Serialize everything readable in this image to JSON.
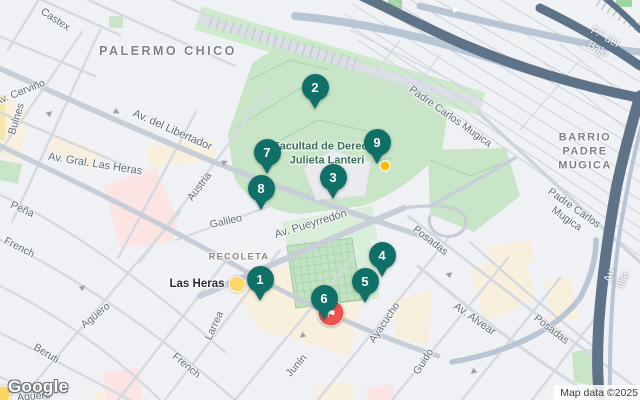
{
  "colors": {
    "teal": "#0f7067",
    "red": "#ee5350",
    "yellow": "#fdd663",
    "park": "#c8e6c7",
    "highway_dark": "#5e7288",
    "highway_light": "#b7c5d5"
  },
  "watermark": {
    "logo": "Google"
  },
  "attribution": {
    "text": "Map data ©2025"
  },
  "map": {
    "markers": [
      {
        "label": "1",
        "x": 260,
        "y": 279
      },
      {
        "label": "2",
        "x": 315,
        "y": 87
      },
      {
        "label": "3",
        "x": 333,
        "y": 177
      },
      {
        "label": "4",
        "x": 382,
        "y": 255
      },
      {
        "label": "5",
        "x": 365,
        "y": 281
      },
      {
        "label": "6",
        "x": 324,
        "y": 298
      },
      {
        "label": "8",
        "x": 261,
        "y": 188
      },
      {
        "label": "7",
        "x": 267,
        "y": 152
      },
      {
        "label": "9",
        "x": 377,
        "y": 142
      }
    ],
    "labels": [
      {
        "text": "Castex",
        "x": 55,
        "y": 20,
        "rot": 33,
        "cls": "st"
      },
      {
        "text": "Av. Cerviño",
        "x": 20,
        "y": 93,
        "rot": -22,
        "cls": "st"
      },
      {
        "text": "Bulnes",
        "x": 17,
        "y": 119,
        "rot": -73,
        "cls": "st"
      },
      {
        "text": "Av. del Libertador",
        "x": 172,
        "y": 131,
        "rot": 24,
        "cls": "st av"
      },
      {
        "text": "Av. Gral. Las Heras",
        "x": 95,
        "y": 165,
        "rot": 9,
        "cls": "st av"
      },
      {
        "text": "Austria",
        "x": 200,
        "y": 187,
        "rot": -53,
        "cls": "st"
      },
      {
        "text": "Galileo",
        "x": 226,
        "y": 222,
        "rot": -13,
        "cls": "st"
      },
      {
        "text": "Peña",
        "x": 22,
        "y": 210,
        "rot": 24,
        "cls": "st"
      },
      {
        "text": "French",
        "x": 19,
        "y": 248,
        "rot": 27,
        "cls": "st"
      },
      {
        "text": "Agüero",
        "x": 96,
        "y": 316,
        "rot": -39,
        "cls": "st"
      },
      {
        "text": "Beruti",
        "x": 46,
        "y": 354,
        "rot": 31,
        "cls": "st"
      },
      {
        "text": "Agüero",
        "x": 34,
        "y": 397,
        "rot": -5,
        "cls": "st"
      },
      {
        "text": "French",
        "x": 186,
        "y": 366,
        "rot": 40,
        "cls": "st"
      },
      {
        "text": "Larrea",
        "x": 215,
        "y": 326,
        "rot": -66,
        "cls": "st"
      },
      {
        "text": "Junín",
        "x": 297,
        "y": 366,
        "rot": -49,
        "cls": "st"
      },
      {
        "text": "Ayacucho",
        "x": 385,
        "y": 323,
        "rot": -56,
        "cls": "st"
      },
      {
        "text": "Guido",
        "x": 424,
        "y": 362,
        "rot": -57,
        "cls": "st"
      },
      {
        "text": "Av. Pueyrredón",
        "x": 311,
        "y": 225,
        "rot": -17,
        "cls": "st av"
      },
      {
        "text": "Posadas",
        "x": 430,
        "y": 241,
        "rot": 38,
        "cls": "st"
      },
      {
        "text": "Posadas",
        "x": 551,
        "y": 330,
        "rot": 38,
        "cls": "st"
      },
      {
        "text": "Av. Alvear",
        "x": 474,
        "y": 320,
        "rot": 35,
        "cls": "st av"
      },
      {
        "text": "Padre Carlos Mugica",
        "x": 450,
        "y": 117,
        "rot": 35,
        "cls": "st"
      },
      {
        "text": "Padre Carlos Mugica",
        "x": 570,
        "y": 214,
        "rot": 35,
        "cls": "st"
      },
      {
        "text": "P.º del Bajo",
        "x": 601,
        "y": 44,
        "rot": 30,
        "cls": "hw"
      },
      {
        "text": "Au Illia",
        "x": 617,
        "y": 278,
        "rot": -72,
        "cls": "hw"
      },
      {
        "text": "PALERMO CHICO",
        "x": 168,
        "y": 52,
        "rot": 0,
        "cls": "area"
      },
      {
        "text": "RECOLETA",
        "x": 239,
        "y": 257,
        "rot": 0,
        "cls": "area sm"
      },
      {
        "text": "BARRIO PADRE\nMUGICA",
        "x": 585,
        "y": 152,
        "rot": 0,
        "cls": "area md"
      },
      {
        "text": "Facultad de Derecho\nJulieta Lanteri",
        "x": 327,
        "y": 154,
        "rot": 0,
        "cls": "poi green"
      },
      {
        "text": "Las Heras",
        "x": 197,
        "y": 284,
        "rot": 0,
        "cls": "poi dark"
      }
    ],
    "icons": [
      {
        "name": "attraction-flag-icon",
        "x": 331,
        "y": 313,
        "cls": "poi-flag",
        "glyph": "⚑"
      },
      {
        "name": "las-heras-station-icon",
        "x": 237,
        "y": 284,
        "cls": "dot-lg"
      },
      {
        "name": "small-poi-icon",
        "x": 385,
        "y": 166,
        "cls": "dot-sm"
      },
      {
        "name": "subway-station-icon",
        "x": 3,
        "y": 394,
        "cls": "dot-lg"
      }
    ],
    "arrows": [
      {
        "x": 50,
        "y": 113,
        "rot": 50
      },
      {
        "x": 117,
        "y": 112,
        "rot": 115
      },
      {
        "x": 225,
        "y": 162,
        "rot": 65
      },
      {
        "x": 83,
        "y": 287,
        "rot": 50
      },
      {
        "x": 302,
        "y": 336,
        "rot": 230
      },
      {
        "x": 450,
        "y": 274,
        "rot": 50
      },
      {
        "x": 473,
        "y": 372,
        "rot": 230
      },
      {
        "x": 456,
        "y": 10,
        "rot": 95,
        "cls": "white"
      }
    ]
  }
}
